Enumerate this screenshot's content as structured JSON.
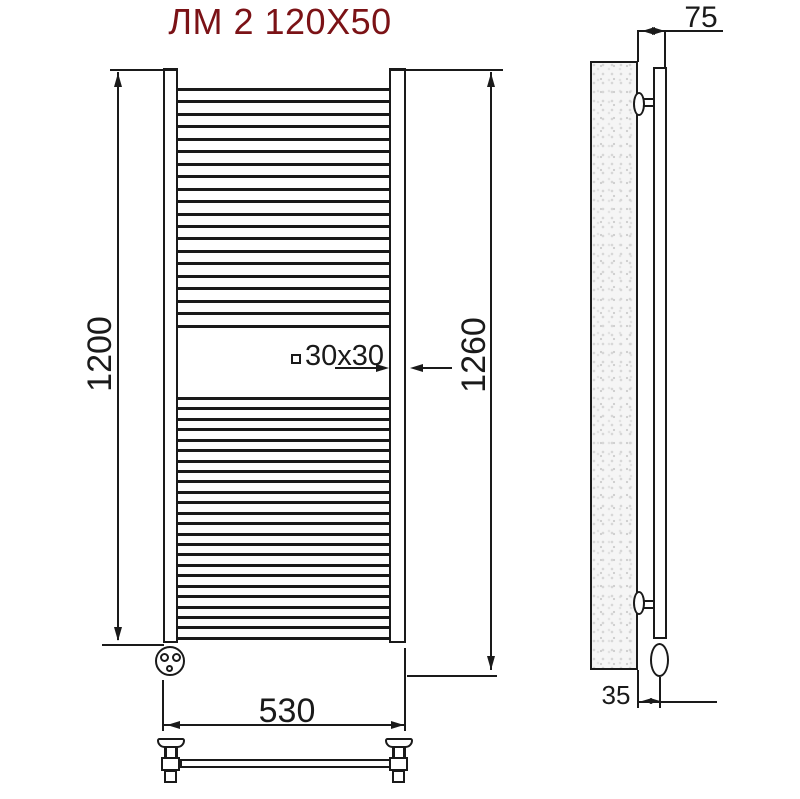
{
  "title": "ЛМ 2 120X50",
  "colors": {
    "line": "#1a1a1a",
    "title_accent": "#7b1216",
    "wall_fill": "#f5f5f5"
  },
  "front_view": {
    "description": "front view of ladder towel radiator",
    "dims": {
      "rail_height": "1200",
      "overall_height": "1260",
      "width": "530",
      "profile": "30x30"
    },
    "rungs": {
      "upper_count": 20,
      "lower_count": 24
    }
  },
  "side_view": {
    "description": "side view with wall mounting",
    "dims": {
      "depth_from_wall": "75",
      "axis_offset": "35"
    }
  },
  "icons": {
    "profile_square": "square-outline-icon"
  }
}
